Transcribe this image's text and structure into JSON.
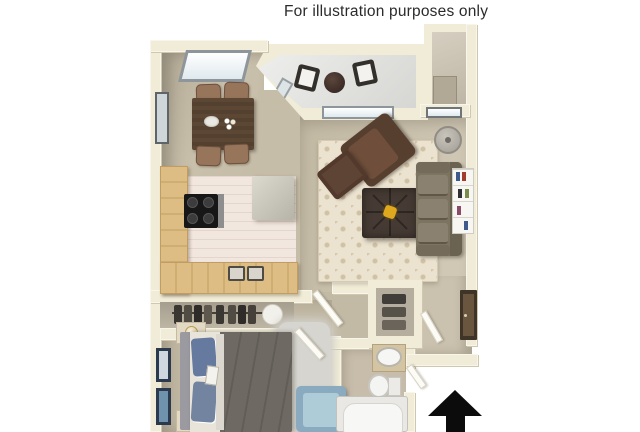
{
  "caption": {
    "text": "For illustration purposes only"
  },
  "plan": {
    "type": "apartment-floor-plan-3d",
    "north_arrow": {
      "direction": "up"
    },
    "rooms": [
      {
        "name": "dining-area",
        "furniture": [
          "dining-table",
          "dining-chair x4",
          "top-wall-window",
          "left-wall-window"
        ]
      },
      {
        "name": "kitchen",
        "furniture": [
          "l-shaped-counter",
          "stove",
          "refrigerator",
          "double-sink",
          "tile-floor"
        ]
      },
      {
        "name": "living-room",
        "furniture": [
          "patterned-area-rug",
          "sofa",
          "armchair",
          "ottoman",
          "coffee-table",
          "bookshelf",
          "floor-lamp",
          "windows"
        ]
      },
      {
        "name": "balcony",
        "furniture": [
          "patio-chair x2",
          "round-patio-table"
        ]
      },
      {
        "name": "storage-closet",
        "furniture": [
          "door"
        ]
      },
      {
        "name": "bedroom",
        "furniture": [
          "bed",
          "blue-pillows",
          "nightstand x2",
          "table-lamp x2",
          "area-rug",
          "blue-armchair",
          "wall-art x2",
          "closet-with-hanging-clothes",
          "hamper"
        ]
      },
      {
        "name": "bathroom",
        "furniture": [
          "vanity-sink",
          "toilet",
          "bathtub"
        ]
      },
      {
        "name": "entry-hallway",
        "furniture": [
          "linen-closet",
          "entry-door",
          "north-arrow"
        ]
      }
    ],
    "colors": {
      "background": "#ffffff",
      "caption_text": "#2b2b2b",
      "walls": "#f1ecd7",
      "carpet": "#c6bda8",
      "kitchen_tile": "#f2e7df",
      "counter_wood": "#ddbd84",
      "stove": "#171717",
      "dining_table": "#5c4735",
      "rug": "#ebe2cf",
      "sofa": "#7c7361",
      "armchair": "#573f30",
      "coffee_table": "#463b34",
      "coffee_table_decor": "#e0a81f",
      "balcony_floor": "#e0e0dd",
      "bed_comforter": "#6b6661",
      "bed_pillows": "#66799e",
      "bedroom_chair": "#8aabbf",
      "bath_fixtures": "#f6f6f4",
      "north_arrow": "#0c0c0c"
    }
  }
}
